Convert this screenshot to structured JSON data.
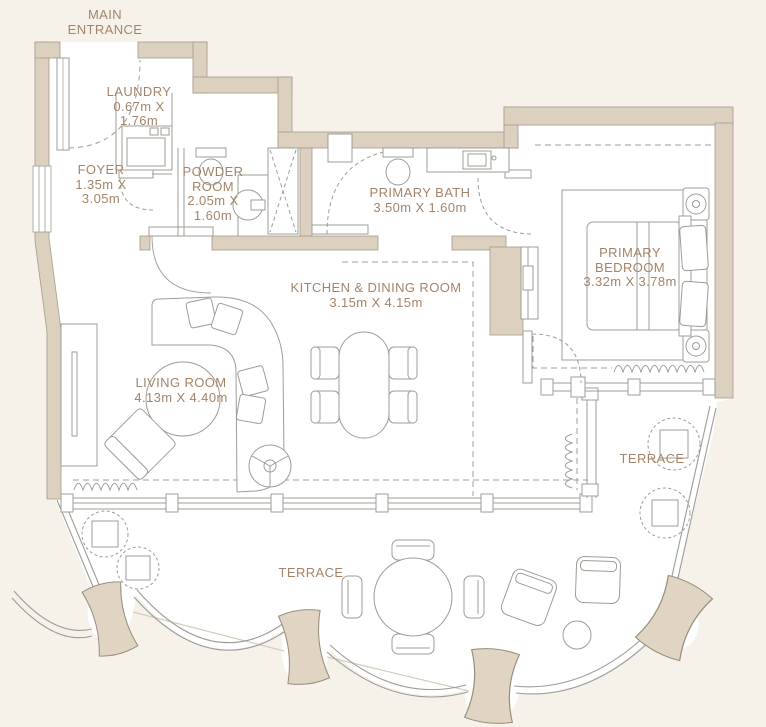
{
  "plan": {
    "type": "apartment-floor-plan",
    "colors": {
      "background": "#f6f2ea",
      "wall": "#dcd0be",
      "wall_outline": "#a79a89",
      "furniture_line": "#9c9c97",
      "label_text": "#a3846a",
      "pillar": "#e0d4c2",
      "floor": "#ffffff"
    },
    "labels": {
      "main_entrance": {
        "lines": [
          "MAIN",
          "ENTRANCE"
        ]
      },
      "laundry": {
        "lines": [
          "LAUNDRY",
          "0.67m X",
          "1.76m"
        ]
      },
      "foyer": {
        "lines": [
          "FOYER",
          "1.35m X",
          "3.05m"
        ]
      },
      "powder_room": {
        "lines": [
          "POWDER",
          "ROOM",
          "2.05m X",
          "1.60m"
        ]
      },
      "primary_bath": {
        "lines": [
          "PRIMARY BATH",
          "3.50m X 1.60m"
        ]
      },
      "primary_bedroom": {
        "lines": [
          "PRIMARY",
          "BEDROOM",
          "3.32m X 3.78m"
        ]
      },
      "kitchen_dining": {
        "lines": [
          "KITCHEN & DINING ROOM",
          "3.15m X 4.15m"
        ]
      },
      "living_room": {
        "lines": [
          "LIVING ROOM",
          "4.13m X 4.40m"
        ]
      },
      "terrace_right": {
        "lines": [
          "TERRACE"
        ]
      },
      "terrace_bottom": {
        "lines": [
          "TERRACE"
        ]
      }
    }
  }
}
